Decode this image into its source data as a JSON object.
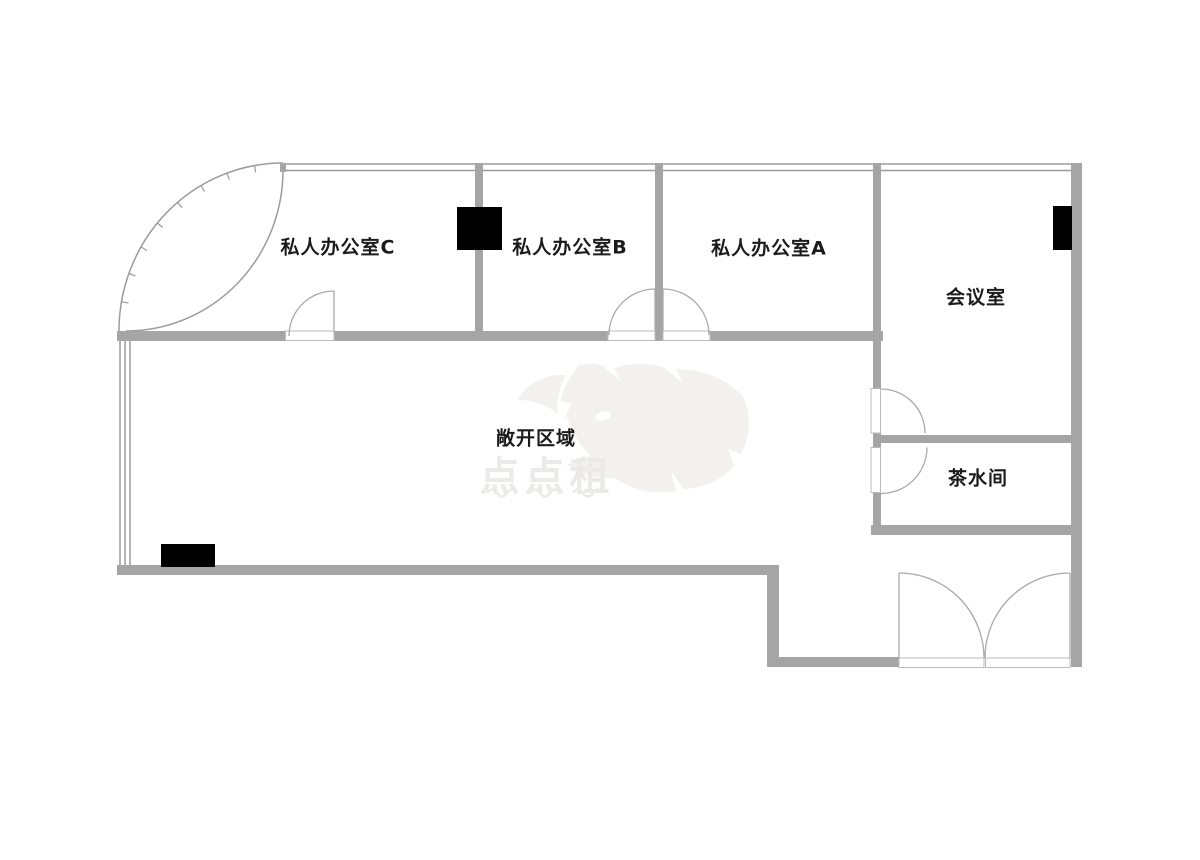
{
  "document": {
    "type": "office-floor-plan",
    "language": "zh-CN"
  },
  "colors": {
    "background": "#ffffff",
    "wall": "#a5a5a5",
    "window_line": "#9b9b9b",
    "door_line": "#aaaaaa",
    "sill_line": "#bbbbbb",
    "column": "#000000",
    "label_text": "#1b1b1b",
    "watermark_fill": "#f2f1f0",
    "watermark_text": "#eceae8"
  },
  "rooms": [
    {
      "id": "private-office-c",
      "label": "私人办公室C"
    },
    {
      "id": "private-office-b",
      "label": "私人办公室B"
    },
    {
      "id": "private-office-a",
      "label": "私人办公室A"
    },
    {
      "id": "meeting-room",
      "label": "会议室"
    },
    {
      "id": "open-area",
      "label": "敞开区域"
    },
    {
      "id": "pantry",
      "label": "茶水间"
    }
  ],
  "watermark": {
    "text": "点点租",
    "icon": "rhino-watermark-icon"
  }
}
